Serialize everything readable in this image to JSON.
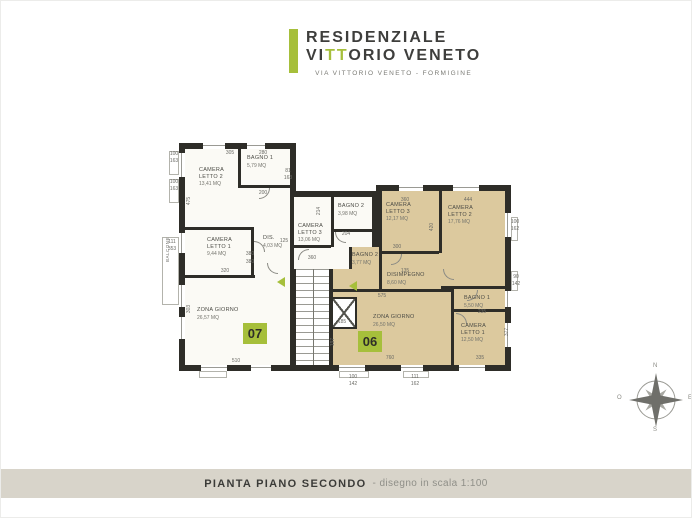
{
  "header": {
    "brand_line1": "RESIDENZIALE",
    "brand_line2_pre": "VI",
    "brand_line2_accent": "TT",
    "brand_line2_post": "ORIO VENETO",
    "address": "VIA VITTORIO VENETO - FORMIGINE"
  },
  "plan": {
    "units": [
      {
        "number": "07"
      },
      {
        "number": "06"
      }
    ],
    "rooms": [
      {
        "unit": "07",
        "name": "CAMERA LETTO 2",
        "area": "13,41 mq"
      },
      {
        "unit": "07",
        "name": "BAGNO 1",
        "area": "5,79 mq"
      },
      {
        "unit": "07",
        "name": "CAMERA LETTO 1",
        "area": "9,44 mq"
      },
      {
        "unit": "07",
        "name": "DIS.",
        "area": "4,03 mq"
      },
      {
        "unit": "07",
        "name": "CAMERA LETTO 3",
        "area": "13,06 mq"
      },
      {
        "unit": "07",
        "name": "BAGNO 2",
        "area": "3,98 mq"
      },
      {
        "unit": "07",
        "name": "ZONA GIORNO",
        "area": "26,57 mq"
      },
      {
        "unit": "06",
        "name": "CAMERA LETTO 3",
        "area": "12,17 mq"
      },
      {
        "unit": "06",
        "name": "CAMERA LETTO 2",
        "area": "17,76 mq"
      },
      {
        "unit": "06",
        "name": "BAGNO 2",
        "area": "3,77 mq"
      },
      {
        "unit": "06",
        "name": "DISIMPEGNO",
        "area": "8,60 mq"
      },
      {
        "unit": "06",
        "name": "BAGNO 1",
        "area": "5,50 mq"
      },
      {
        "unit": "06",
        "name": "CAMERA LETTO 1",
        "area": "12,50 mq"
      },
      {
        "unit": "06",
        "name": "ZONA GIORNO",
        "area": "26,50 mq"
      }
    ],
    "dims": [
      "305",
      "280",
      "100",
      "163",
      "100",
      "163",
      "81",
      "163",
      "200",
      "475",
      "380",
      "380",
      "125",
      "320",
      "303",
      "510",
      "214",
      "204",
      "360",
      "360",
      "444",
      "300",
      "420",
      "575",
      "760",
      "197",
      "185",
      "235",
      "335",
      "377",
      "100",
      "162",
      "90",
      "142",
      "111",
      "353",
      "100",
      "142",
      "111",
      "162",
      "135"
    ],
    "balcony_label": "BALCONE",
    "compass": {
      "north": "N",
      "east": "E",
      "south": "S",
      "west": "O"
    }
  },
  "footer": {
    "title": "PIANTA PIANO SECONDO",
    "subtitle": "- disegno in scala 1:100"
  },
  "colors": {
    "accent_green": "#a6bf3b",
    "wall_dark": "#2e2d28",
    "apartment_06_fill": "#dcc99e",
    "apartment_07_fill": "#fbfaf5",
    "footer_band": "#d8d4ca"
  }
}
